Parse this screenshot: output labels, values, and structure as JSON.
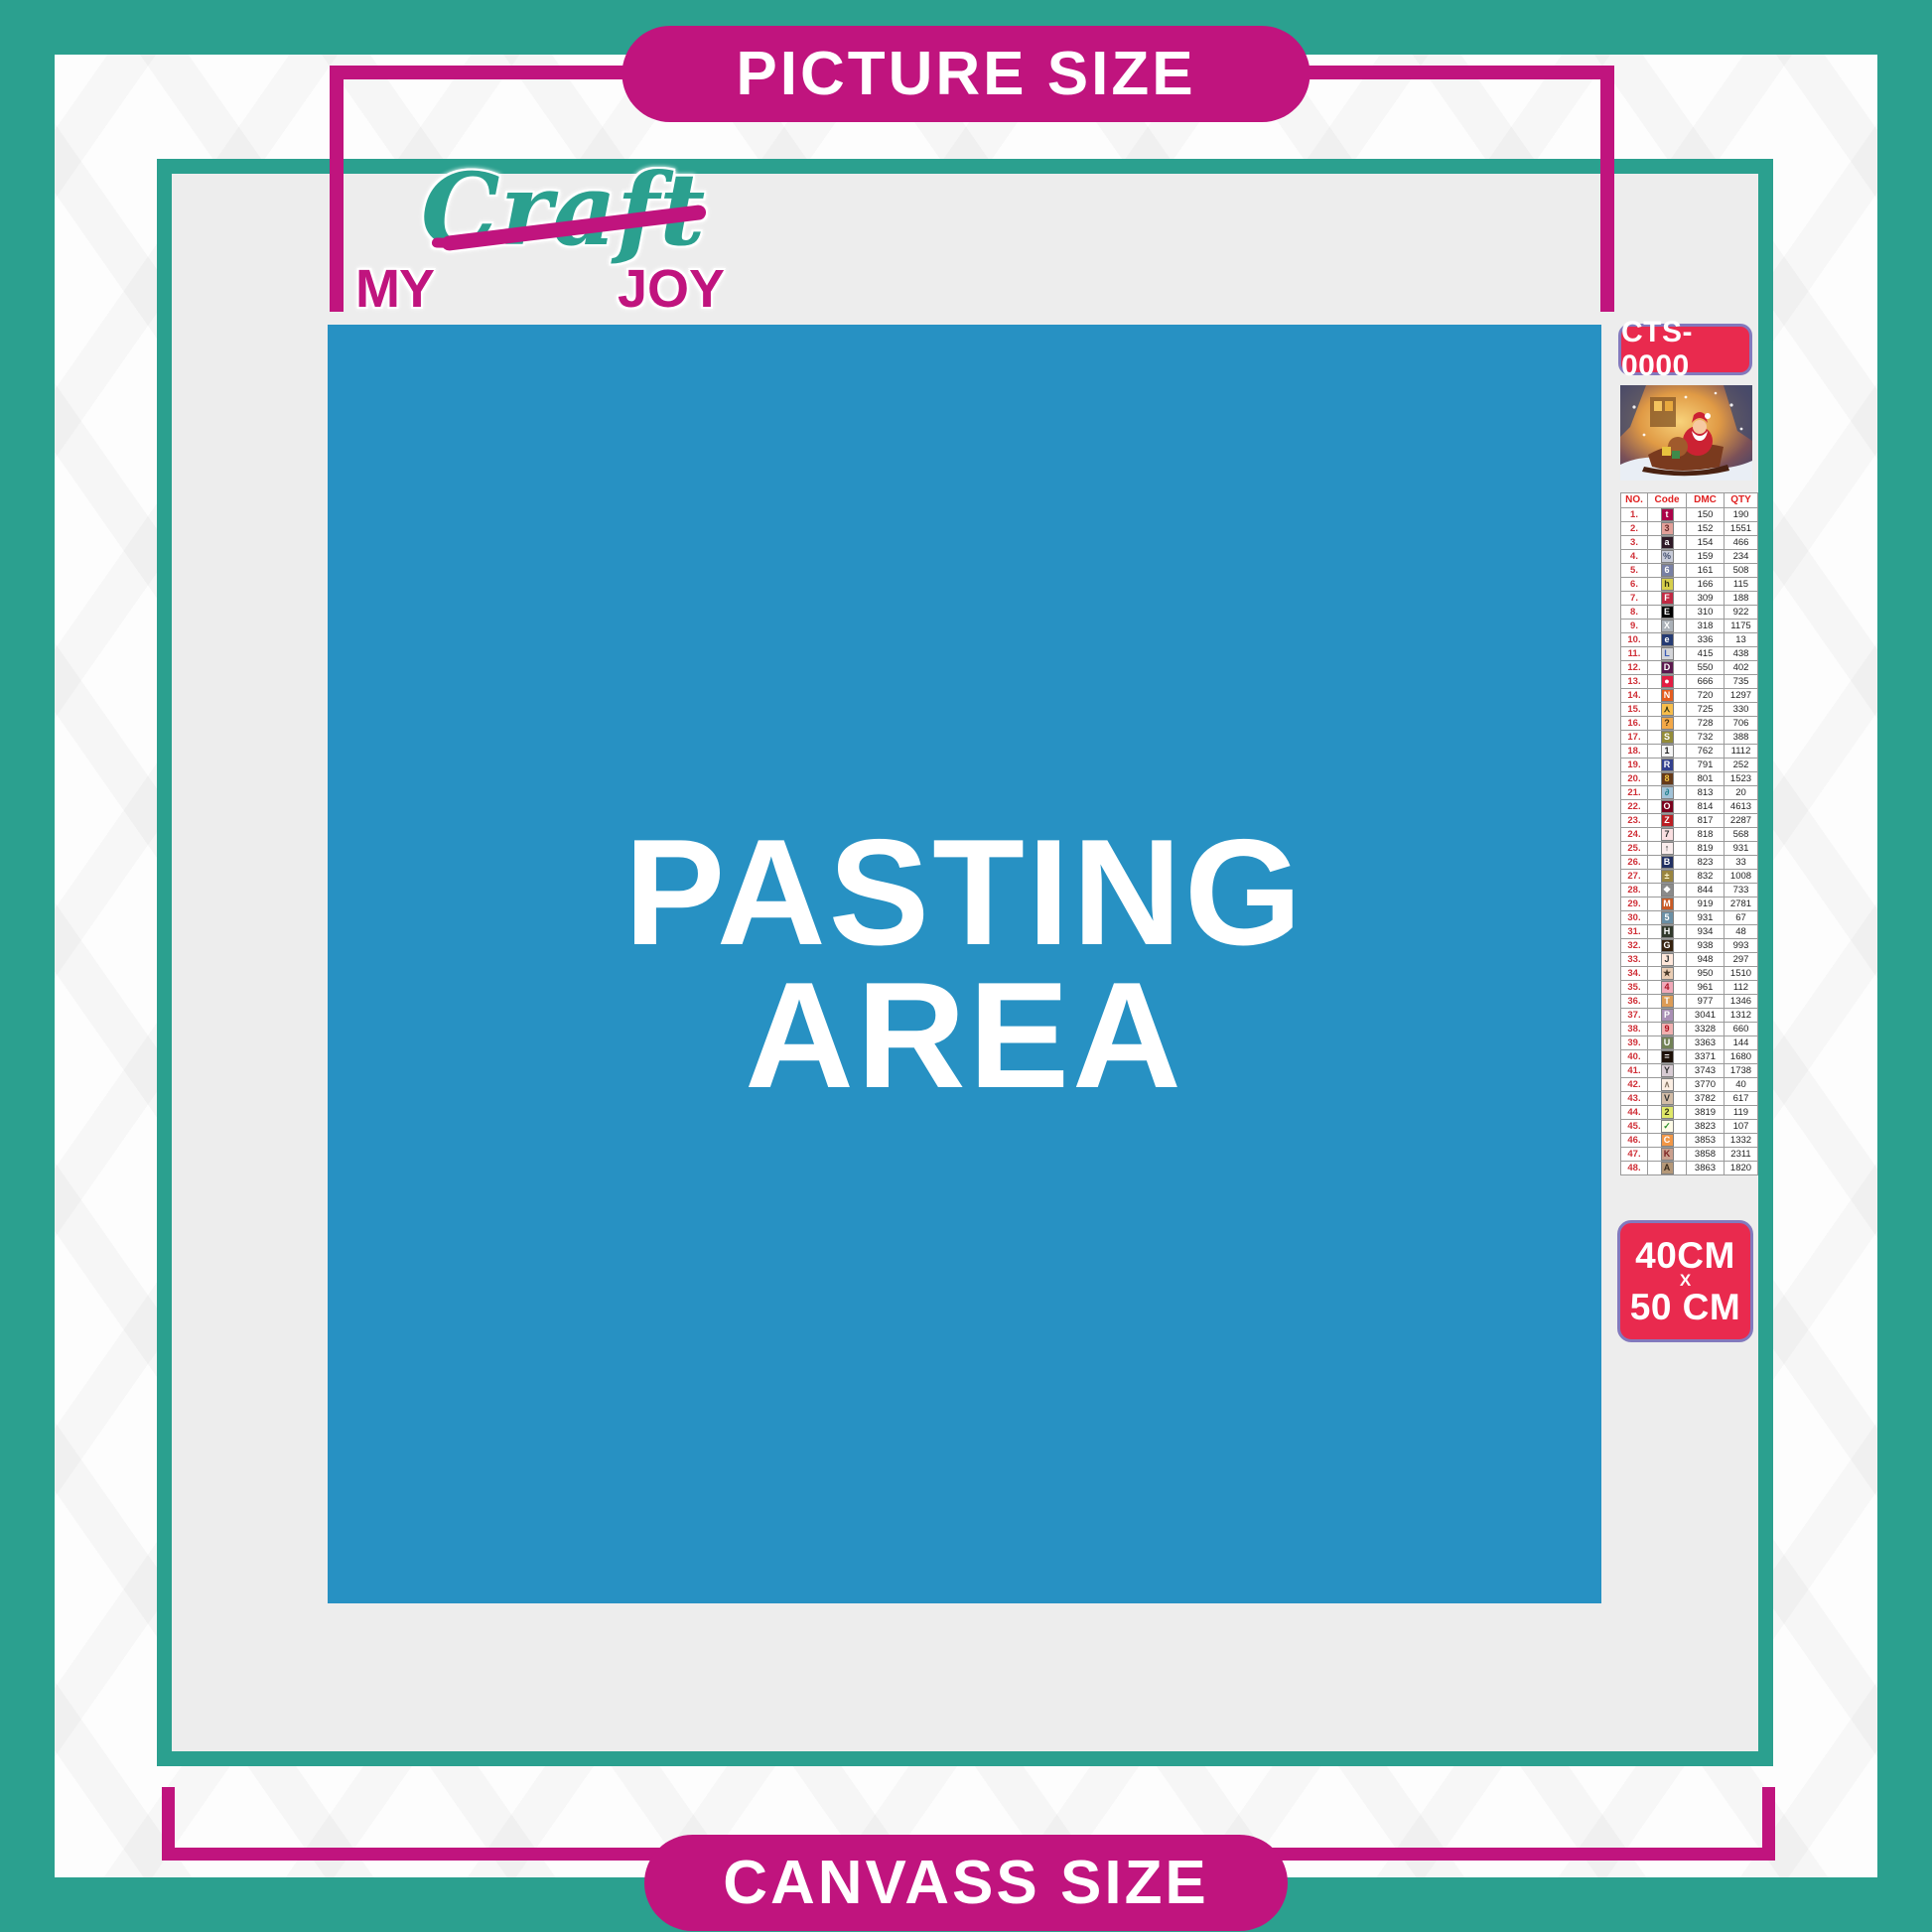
{
  "brand": {
    "my": "MY",
    "craft": "Craft",
    "joy": "JOY"
  },
  "header_pill": "PICTURE SIZE",
  "footer_pill": "CANVASS SIZE",
  "pasting_area": {
    "line1": "PASTING",
    "line2": "AREA"
  },
  "product": {
    "sku": "CTS-0000",
    "thumbnail": "christmas-santa-sleigh-preview",
    "size": {
      "line1": "40CM",
      "line2": "X",
      "line3": "50 CM"
    }
  },
  "colors": {
    "teal": "#2ba08f",
    "magenta": "#c0147e",
    "blue": "#2791c3",
    "red_label": "#e92a4e",
    "canvas_gray": "#ededed"
  },
  "legend": {
    "headers": [
      "NO.",
      "Code",
      "DMC",
      "QTY"
    ],
    "rows": [
      {
        "no": "1.",
        "symbol": "t",
        "sym_bg": "#ab0249",
        "sym_fg": "#ffffff",
        "dmc": "150",
        "qty": "190"
      },
      {
        "no": "2.",
        "symbol": "3",
        "sym_bg": "#e2a099",
        "sym_fg": "#6a2c2c",
        "dmc": "152",
        "qty": "1551"
      },
      {
        "no": "3.",
        "symbol": "a",
        "sym_bg": "#2f1a26",
        "sym_fg": "#ffffff",
        "dmc": "154",
        "qty": "466"
      },
      {
        "no": "4.",
        "symbol": "%",
        "sym_bg": "#c7cad7",
        "sym_fg": "#44506e",
        "dmc": "159",
        "qty": "234"
      },
      {
        "no": "5.",
        "symbol": "6",
        "sym_bg": "#7880a4",
        "sym_fg": "#ffffff",
        "dmc": "161",
        "qty": "508"
      },
      {
        "no": "6.",
        "symbol": "h",
        "sym_bg": "#d6ce4b",
        "sym_fg": "#333311",
        "dmc": "166",
        "qty": "115"
      },
      {
        "no": "7.",
        "symbol": "F",
        "sym_bg": "#c02943",
        "sym_fg": "#ffffff",
        "dmc": "309",
        "qty": "188"
      },
      {
        "no": "8.",
        "symbol": "E",
        "sym_bg": "#000000",
        "sym_fg": "#ffffff",
        "dmc": "310",
        "qty": "922"
      },
      {
        "no": "9.",
        "symbol": "X",
        "sym_bg": "#abb1b8",
        "sym_fg": "#ffffff",
        "dmc": "318",
        "qty": "1175"
      },
      {
        "no": "10.",
        "symbol": "e",
        "sym_bg": "#253b73",
        "sym_fg": "#ffffff",
        "dmc": "336",
        "qty": "13"
      },
      {
        "no": "11.",
        "symbol": "L",
        "sym_bg": "#d3d4d8",
        "sym_fg": "#3b5bb5",
        "dmc": "415",
        "qty": "438"
      },
      {
        "no": "12.",
        "symbol": "D",
        "sym_bg": "#5c184e",
        "sym_fg": "#ffffff",
        "dmc": "550",
        "qty": "402"
      },
      {
        "no": "13.",
        "symbol": "●",
        "sym_bg": "#e31d42",
        "sym_fg": "#ffffff",
        "dmc": "666",
        "qty": "735"
      },
      {
        "no": "14.",
        "symbol": "N",
        "sym_bg": "#e55c1f",
        "sym_fg": "#ffffff",
        "dmc": "720",
        "qty": "1297"
      },
      {
        "no": "15.",
        "symbol": "⋏",
        "sym_bg": "#f7bd4a",
        "sym_fg": "#333311",
        "dmc": "725",
        "qty": "330"
      },
      {
        "no": "16.",
        "symbol": "?",
        "sym_bg": "#f3a847",
        "sym_fg": "#4a3310",
        "dmc": "728",
        "qty": "706"
      },
      {
        "no": "17.",
        "symbol": "S",
        "sym_bg": "#948c38",
        "sym_fg": "#ffffff",
        "dmc": "732",
        "qty": "388"
      },
      {
        "no": "18.",
        "symbol": "1",
        "sym_bg": "#f4f4f4",
        "sym_fg": "#222222",
        "dmc": "762",
        "qty": "1112"
      },
      {
        "no": "19.",
        "symbol": "R",
        "sym_bg": "#33408f",
        "sym_fg": "#ffffff",
        "dmc": "791",
        "qty": "252"
      },
      {
        "no": "20.",
        "symbol": "8",
        "sym_bg": "#653919",
        "sym_fg": "#f0c040",
        "dmc": "801",
        "qty": "1523"
      },
      {
        "no": "21.",
        "symbol": "∂",
        "sym_bg": "#a1c2d7",
        "sym_fg": "#1b7e8a",
        "dmc": "813",
        "qty": "20"
      },
      {
        "no": "22.",
        "symbol": "O",
        "sym_bg": "#7b001d",
        "sym_fg": "#ffffff",
        "dmc": "814",
        "qty": "4613"
      },
      {
        "no": "23.",
        "symbol": "Z",
        "sym_bg": "#bb1e23",
        "sym_fg": "#ffffff",
        "dmc": "817",
        "qty": "2287"
      },
      {
        "no": "24.",
        "symbol": "7",
        "sym_bg": "#fadfe1",
        "sym_fg": "#333333",
        "dmc": "818",
        "qty": "568"
      },
      {
        "no": "25.",
        "symbol": "↑",
        "sym_bg": "#f9ecec",
        "sym_fg": "#222222",
        "dmc": "819",
        "qty": "931"
      },
      {
        "no": "26.",
        "symbol": "B",
        "sym_bg": "#213063",
        "sym_fg": "#ffffff",
        "dmc": "823",
        "qty": "33"
      },
      {
        "no": "27.",
        "symbol": "±",
        "sym_bg": "#9a8540",
        "sym_fg": "#fff8d0",
        "dmc": "832",
        "qty": "1008"
      },
      {
        "no": "28.",
        "symbol": "❖",
        "sym_bg": "#8a8a8a",
        "sym_fg": "#ffffff",
        "dmc": "844",
        "qty": "733"
      },
      {
        "no": "29.",
        "symbol": "M",
        "sym_bg": "#c85a25",
        "sym_fg": "#ffffff",
        "dmc": "919",
        "qty": "2781"
      },
      {
        "no": "30.",
        "symbol": "5",
        "sym_bg": "#6a8fa5",
        "sym_fg": "#ffffff",
        "dmc": "931",
        "qty": "67"
      },
      {
        "no": "31.",
        "symbol": "H",
        "sym_bg": "#31392c",
        "sym_fg": "#ffffff",
        "dmc": "934",
        "qty": "48"
      },
      {
        "no": "32.",
        "symbol": "G",
        "sym_bg": "#36220f",
        "sym_fg": "#ffffff",
        "dmc": "938",
        "qty": "993"
      },
      {
        "no": "33.",
        "symbol": "J",
        "sym_bg": "#fee7da",
        "sym_fg": "#333333",
        "dmc": "948",
        "qty": "297"
      },
      {
        "no": "34.",
        "symbol": "★",
        "sym_bg": "#eacdb4",
        "sym_fg": "#4a3a2a",
        "dmc": "950",
        "qty": "1510"
      },
      {
        "no": "35.",
        "symbol": "4",
        "sym_bg": "#f0a8b8",
        "sym_fg": "#aa1122",
        "dmc": "961",
        "qty": "112"
      },
      {
        "no": "36.",
        "symbol": "T",
        "sym_bg": "#dc9c56",
        "sym_fg": "#ffffff",
        "dmc": "977",
        "qty": "1346"
      },
      {
        "no": "37.",
        "symbol": "P",
        "sym_bg": "#a98fb5",
        "sym_fg": "#ffffff",
        "dmc": "3041",
        "qty": "1312"
      },
      {
        "no": "38.",
        "symbol": "9",
        "sym_bg": "#f0b0b0",
        "sym_fg": "#b01020",
        "dmc": "3328",
        "qty": "660"
      },
      {
        "no": "39.",
        "symbol": "U",
        "sym_bg": "#728256",
        "sym_fg": "#ffffff",
        "dmc": "3363",
        "qty": "144"
      },
      {
        "no": "40.",
        "symbol": "=",
        "sym_bg": "#1e1108",
        "sym_fg": "#ffffff",
        "dmc": "3371",
        "qty": "1680"
      },
      {
        "no": "41.",
        "symbol": "Y",
        "sym_bg": "#d7cbd3",
        "sym_fg": "#333333",
        "dmc": "3743",
        "qty": "1738"
      },
      {
        "no": "42.",
        "symbol": "∧",
        "sym_bg": "#fbeee3",
        "sym_fg": "#887766",
        "dmc": "3770",
        "qty": "40"
      },
      {
        "no": "43.",
        "symbol": "V",
        "sym_bg": "#d2bca6",
        "sym_fg": "#333333",
        "dmc": "3782",
        "qty": "617"
      },
      {
        "no": "44.",
        "symbol": "2",
        "sym_bg": "#e0e868",
        "sym_fg": "#333311",
        "dmc": "3819",
        "qty": "119"
      },
      {
        "no": "45.",
        "symbol": "✓",
        "sym_bg": "#fffbe7",
        "sym_fg": "#2a8f2a",
        "dmc": "3823",
        "qty": "107"
      },
      {
        "no": "46.",
        "symbol": "C",
        "sym_bg": "#f29746",
        "sym_fg": "#ffffff",
        "dmc": "3853",
        "qty": "1332"
      },
      {
        "no": "47.",
        "symbol": "K",
        "sym_bg": "#caa08e",
        "sym_fg": "#7a2020",
        "dmc": "3858",
        "qty": "2311"
      },
      {
        "no": "48.",
        "symbol": "A",
        "sym_bg": "#b59878",
        "sym_fg": "#3a2a1a",
        "dmc": "3863",
        "qty": "1820"
      }
    ]
  }
}
